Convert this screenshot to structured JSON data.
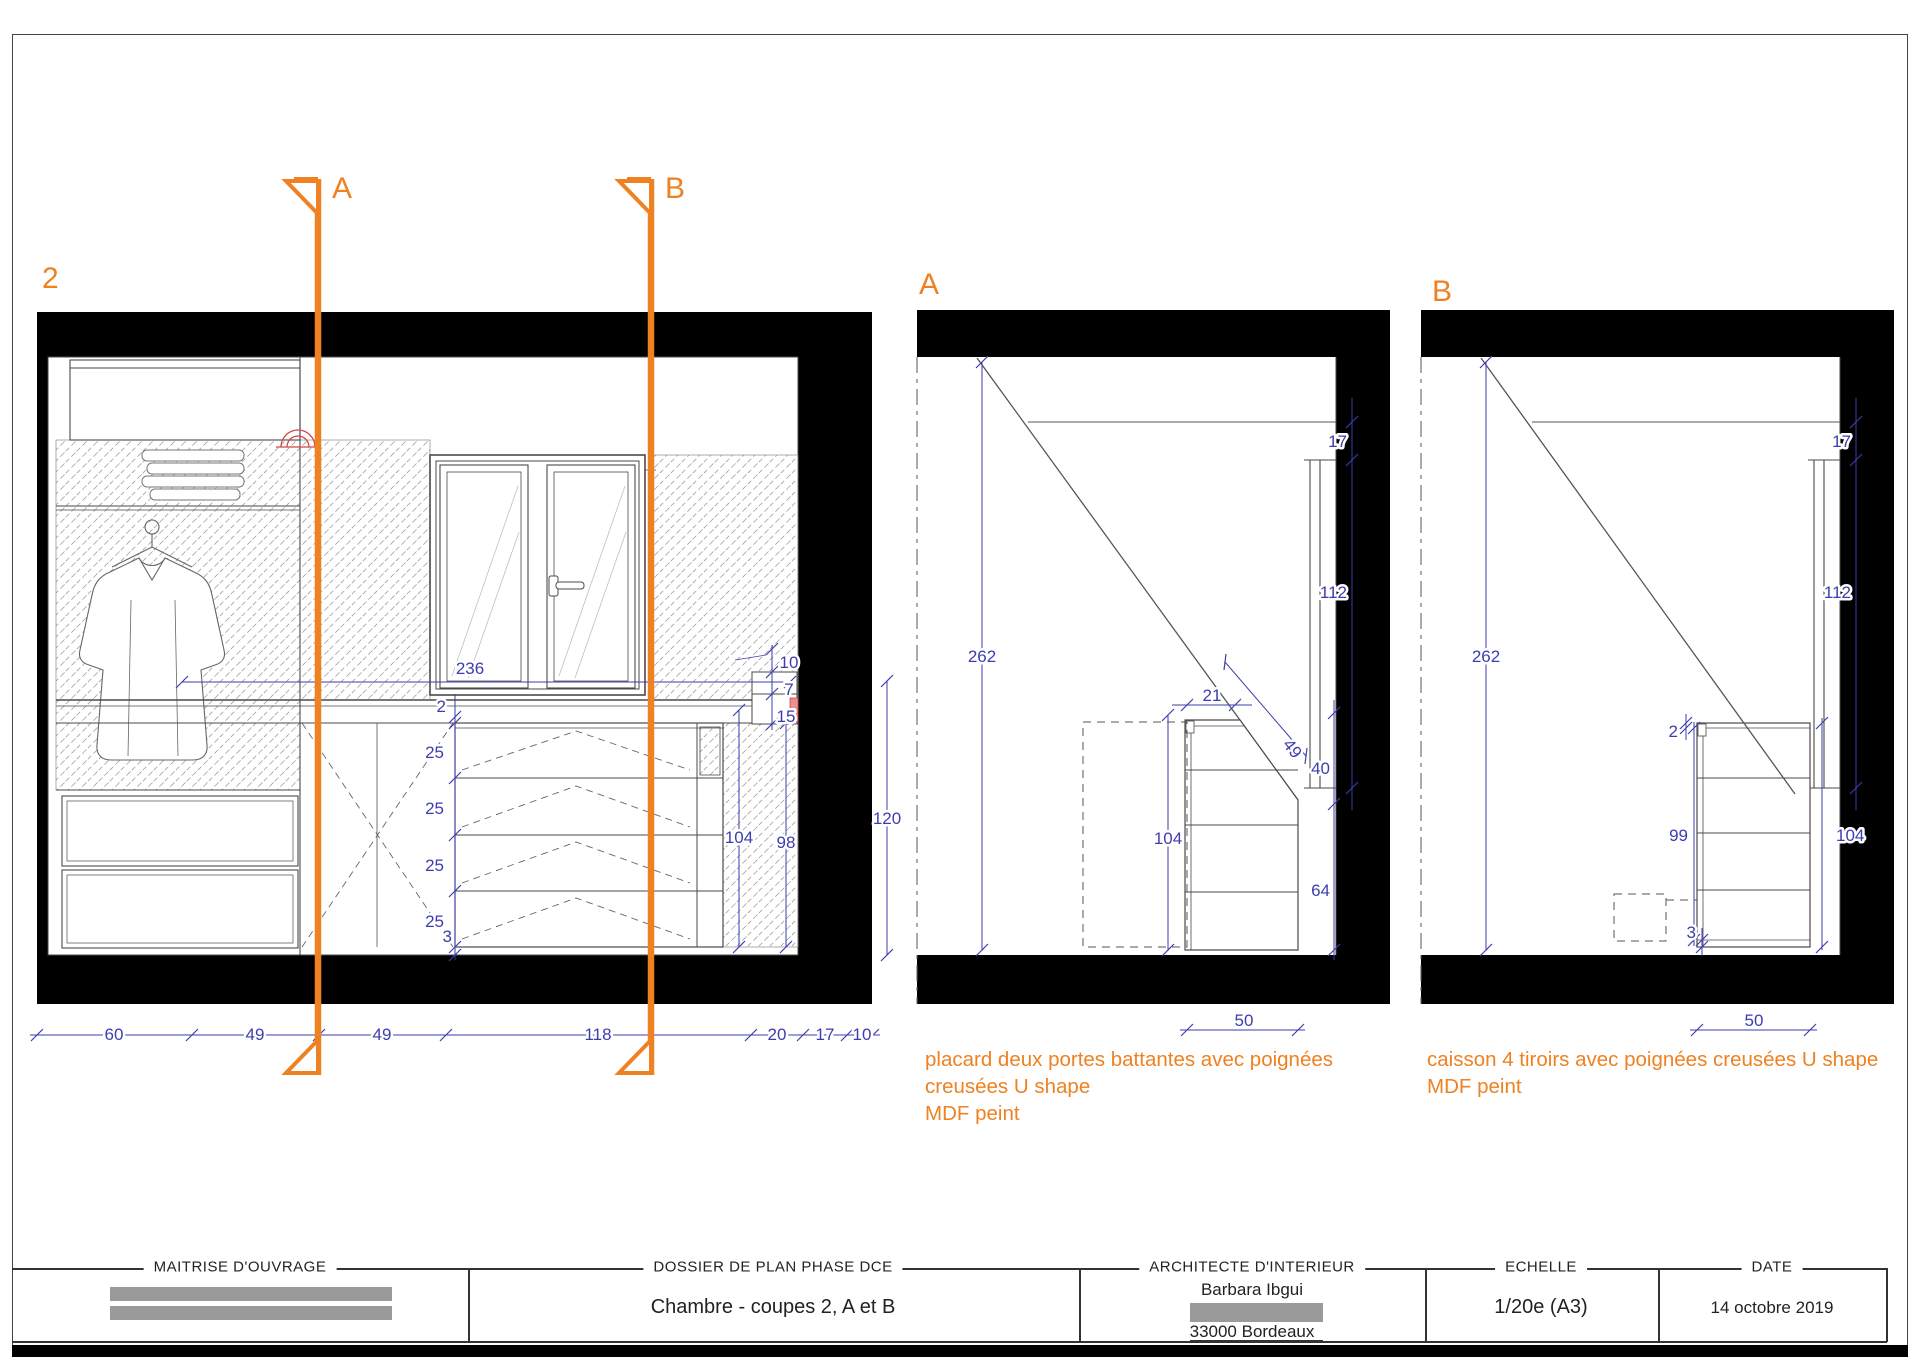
{
  "colors": {
    "accent": "#ee8222",
    "dim_blue": "#3d3dae",
    "line": "#4a4a4a",
    "red": "#d24545",
    "redact": "#9a9a9a"
  },
  "labels": {
    "section2": "2",
    "sectionA": "A",
    "sectionB": "B",
    "cut_a": "A",
    "cut_b": "B"
  },
  "section2": {
    "dim_counter_width": "236",
    "drawer_stack": [
      "2",
      "25",
      "25",
      "25",
      "25",
      "3"
    ],
    "niche_dims": [
      "10",
      "7",
      "15"
    ],
    "dim_counter_height": "104",
    "dim_chest_height": "98",
    "dim_sill_height": "120",
    "bottom_dims": [
      "60",
      "49",
      "49",
      "118",
      "20",
      "17",
      "10"
    ]
  },
  "sectionA": {
    "dim_room_height": "262",
    "dim_panel_top": "17",
    "dim_panel_height": "112",
    "dim_upper": "40",
    "dim_lower": "64",
    "dim_top_depth": "21",
    "dim_slope": "49",
    "dim_cabinet_height": "104",
    "dim_cabinet_width": "50",
    "note": [
      "placard deux portes battantes avec poignées",
      "creusées U shape",
      "MDF peint"
    ]
  },
  "sectionB": {
    "dim_room_height": "262",
    "dim_panel_top": "17",
    "dim_panel_height": "112",
    "dim_top_thickness": "2",
    "dim_drawers_height": "99",
    "dim_cabinet_height": "104",
    "dim_bottom_gap": "3",
    "dim_cabinet_width": "50",
    "note": [
      "caisson 4  tiroirs avec poignées creusées U shape",
      "MDF peint"
    ]
  },
  "titleblock": {
    "owner": {
      "header": "MAITRISE D'OUVRAGE"
    },
    "dossier": {
      "header": "DOSSIER DE PLAN PHASE DCE",
      "value": "Chambre - coupes 2, A et B"
    },
    "architect": {
      "header": "ARCHITECTE D'INTERIEUR",
      "name": "Barbara Ibgui",
      "city": "33000 Bordeaux"
    },
    "scale": {
      "header": "ECHELLE",
      "value": "1/20e (A3)"
    },
    "date": {
      "header": "DATE",
      "value": "14 octobre 2019"
    }
  }
}
